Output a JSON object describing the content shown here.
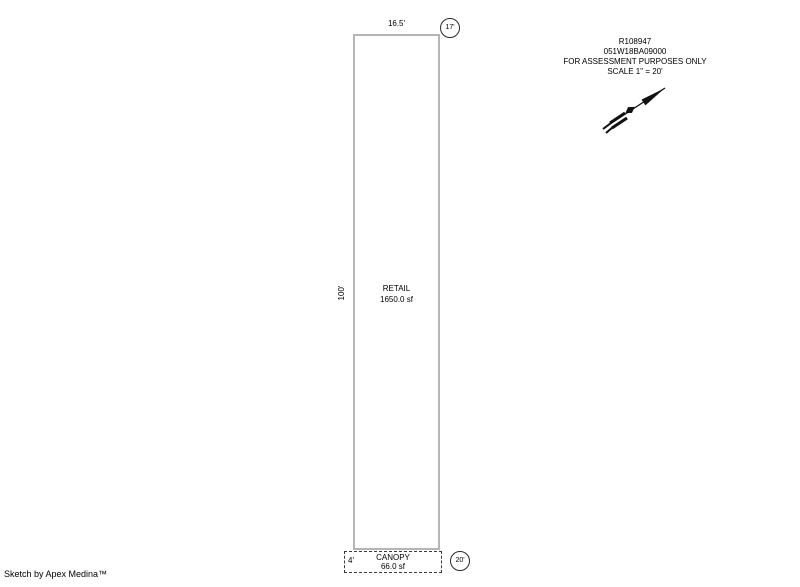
{
  "document": {
    "record_id": "R108947",
    "parcel_id": "051W18BA09000",
    "disclaimer": "FOR ASSESSMENT PURPOSES ONLY",
    "scale": "SCALE 1\" = 20'",
    "footer_credit": "Sketch by Apex Medina™"
  },
  "sketch": {
    "retail": {
      "label": "RETAIL",
      "area": "1650.0 sf",
      "width_dim": "16.5'",
      "height_dim": "100'",
      "corner_tag": "17'"
    },
    "canopy": {
      "label": "CANOPY",
      "area": "66.0 sf",
      "depth_dim": "4'",
      "corner_tag": "20'"
    },
    "north_arrow_direction": "northeast"
  },
  "colors": {
    "background": "#ffffff",
    "outline_gray": "#b5b5b5",
    "canopy_dash": "#3a3a3a",
    "text": "#000000"
  }
}
